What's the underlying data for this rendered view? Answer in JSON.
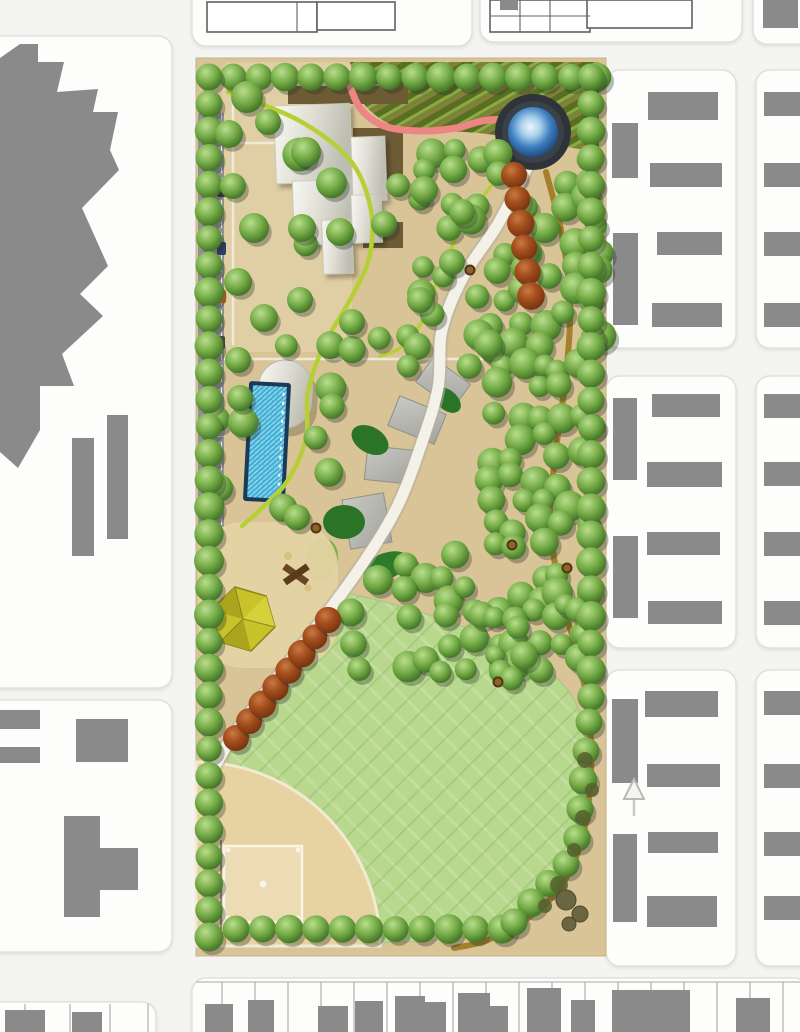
{
  "plan": {
    "kind": "park-master-plan",
    "orientation": "north-up"
  },
  "palette": {
    "canvas": "#f4f4f2",
    "block": "#fdfdfc",
    "block_border": "#dcdcd8",
    "building_gray": "#8a8a8a",
    "park_tan": "#d8c497",
    "road_gray": "#8f9193",
    "lawn_green": "#b8d88d",
    "infield_tan": "#e7d2a2",
    "pond_ring": "#2f343a",
    "pond_water": "#3d7fc1",
    "pool_water": "#3fb0d6",
    "pool_deck": "#1b3a57",
    "path_pink": "#ee8585",
    "path_chartreuse": "#b6cf36",
    "path_dirt": "#a5802c",
    "path_walk": "#f4f2e8",
    "tree_green": "#74ab47",
    "tree_red": "#9a4518",
    "plaza_brown": "#6d5b35",
    "terrace_gray": "#b9b9b4",
    "slope_green": "#2b7326",
    "pavilion_yellow": "#c9c32b"
  },
  "scene": {
    "blocks": [
      [
        -44,
        36,
        216,
        652
      ],
      [
        -44,
        700,
        216,
        252
      ],
      [
        -44,
        1002,
        200,
        62
      ],
      [
        192,
        -36,
        280,
        82
      ],
      [
        480,
        -36,
        262,
        78
      ],
      [
        753,
        -36,
        70,
        80
      ],
      [
        606,
        70,
        130,
        278
      ],
      [
        606,
        376,
        130,
        272
      ],
      [
        606,
        670,
        130,
        296
      ],
      [
        756,
        70,
        80,
        278
      ],
      [
        756,
        376,
        80,
        272
      ],
      [
        756,
        670,
        80,
        296
      ],
      [
        192,
        978,
        616,
        86
      ]
    ],
    "zigzag": "0,58 20,44 38,44 38,62 64,62 57,92 98,89 93,112 118,112 110,150 119,170 82,208 108,266 80,294 103,316 62,354 74,386 40,386 40,430 18,468 0,452",
    "gray_buildings": [
      [
        72,
        438,
        22,
        118
      ],
      [
        107,
        415,
        21,
        124
      ],
      [
        -20,
        710,
        60,
        19
      ],
      [
        -20,
        747,
        60,
        16
      ],
      [
        76,
        719,
        52,
        43
      ],
      [
        64,
        816,
        36,
        101
      ],
      [
        100,
        848,
        38,
        42
      ],
      [
        648,
        92,
        70,
        28
      ],
      [
        612,
        123,
        26,
        55
      ],
      [
        650,
        163,
        72,
        24
      ],
      [
        613,
        233,
        25,
        92
      ],
      [
        657,
        232,
        65,
        23
      ],
      [
        652,
        303,
        70,
        24
      ],
      [
        613,
        398,
        24,
        82
      ],
      [
        652,
        394,
        68,
        23
      ],
      [
        647,
        462,
        75,
        25
      ],
      [
        613,
        536,
        25,
        82
      ],
      [
        647,
        532,
        73,
        23
      ],
      [
        648,
        601,
        74,
        23
      ],
      [
        612,
        699,
        26,
        84
      ],
      [
        645,
        691,
        73,
        26
      ],
      [
        647,
        764,
        73,
        23
      ],
      [
        613,
        834,
        24,
        88
      ],
      [
        648,
        832,
        70,
        21
      ],
      [
        647,
        896,
        70,
        31
      ],
      [
        764,
        92,
        36,
        24
      ],
      [
        764,
        163,
        36,
        24
      ],
      [
        764,
        232,
        36,
        24
      ],
      [
        764,
        303,
        36,
        24
      ],
      [
        764,
        394,
        36,
        24
      ],
      [
        764,
        462,
        36,
        24
      ],
      [
        764,
        532,
        36,
        24
      ],
      [
        764,
        601,
        36,
        24
      ],
      [
        764,
        691,
        36,
        24
      ],
      [
        764,
        764,
        36,
        24
      ],
      [
        764,
        832,
        36,
        24
      ],
      [
        764,
        896,
        36,
        24
      ],
      [
        763,
        0,
        35,
        28
      ]
    ],
    "outline_buildings": [
      [
        207,
        2,
        110,
        30
      ],
      [
        317,
        2,
        78,
        28
      ],
      [
        490,
        0,
        100,
        32
      ],
      [
        587,
        0,
        105,
        28
      ]
    ],
    "outline_lines": [
      [
        297,
        2,
        297,
        32
      ],
      [
        520,
        0,
        520,
        32
      ],
      [
        550,
        0,
        550,
        32
      ],
      [
        490,
        16,
        590,
        16
      ],
      [
        500,
        0,
        518,
        10
      ]
    ],
    "bottom_dividers": [
      222,
      255,
      288,
      321,
      354,
      387,
      420,
      453,
      486,
      519,
      552,
      585,
      618,
      651,
      684,
      717,
      750,
      783
    ],
    "west_strip_dividers": [
      25,
      70,
      110,
      148
    ],
    "west_strip_squares": [
      [
        5,
        1010,
        40,
        22
      ],
      [
        72,
        1012,
        30,
        20
      ]
    ],
    "footprints": [
      [
        205,
        1004,
        28,
        28
      ],
      [
        248,
        1000,
        26,
        32
      ],
      [
        318,
        1006,
        30,
        26
      ],
      [
        355,
        1001,
        28,
        31
      ],
      [
        395,
        996,
        30,
        36
      ],
      [
        424,
        1002,
        22,
        30
      ],
      [
        458,
        993,
        32,
        39
      ],
      [
        490,
        1006,
        18,
        26
      ],
      [
        527,
        988,
        34,
        44
      ],
      [
        571,
        1000,
        24,
        32
      ],
      [
        612,
        990,
        78,
        42
      ],
      [
        736,
        998,
        34,
        34
      ]
    ],
    "paths": [
      {
        "name": "pink-garden-walk",
        "color": "#ee8585",
        "width": 7,
        "points": [
          [
            348,
            80
          ],
          [
            360,
            108
          ],
          [
            384,
            126
          ],
          [
            420,
            131
          ],
          [
            456,
            128
          ],
          [
            482,
            121
          ],
          [
            505,
            120
          ],
          [
            516,
            126
          ]
        ]
      },
      {
        "name": "chartreuse-loop-trail",
        "color": "#b6cf36",
        "width": 4.5,
        "points": [
          [
            228,
            92
          ],
          [
            298,
            120
          ],
          [
            350,
            160
          ],
          [
            371,
            210
          ],
          [
            369,
            258
          ],
          [
            350,
            300
          ],
          [
            324,
            345
          ],
          [
            308,
            392
          ],
          [
            306,
            438
          ],
          [
            288,
            480
          ],
          [
            262,
            508
          ],
          [
            242,
            526
          ]
        ]
      },
      {
        "name": "chartreuse-spur-trail",
        "color": "#b6cf36",
        "width": 3.5,
        "points": [
          [
            512,
            160
          ],
          [
            482,
            198
          ],
          [
            455,
            240
          ],
          [
            436,
            285
          ],
          [
            420,
            325
          ],
          [
            400,
            348
          ],
          [
            380,
            356
          ]
        ]
      },
      {
        "name": "dirt-trail",
        "color": "#a5802c",
        "width": 6,
        "points": [
          [
            546,
            172
          ],
          [
            562,
            235
          ],
          [
            570,
            305
          ],
          [
            566,
            375
          ],
          [
            556,
            450
          ],
          [
            550,
            520
          ],
          [
            560,
            590
          ],
          [
            576,
            650
          ],
          [
            588,
            706
          ],
          [
            591,
            770
          ],
          [
            583,
            835
          ],
          [
            562,
            885
          ],
          [
            528,
            918
          ],
          [
            488,
            940
          ],
          [
            454,
            948
          ]
        ]
      },
      {
        "name": "main-walk",
        "color": "#f4f2e8",
        "casing": "#b4b1a3",
        "width": 11,
        "points": [
          [
            528,
            166
          ],
          [
            498,
            224
          ],
          [
            463,
            277
          ],
          [
            442,
            330
          ],
          [
            438,
            388
          ],
          [
            420,
            448
          ],
          [
            398,
            505
          ],
          [
            368,
            556
          ],
          [
            331,
            608
          ],
          [
            291,
            660
          ],
          [
            255,
            706
          ],
          [
            229,
            742
          ],
          [
            215,
            766
          ]
        ]
      }
    ],
    "tree_rows_green": [
      [
        233,
        77,
        597,
        77,
        26
      ],
      [
        209,
        77,
        209,
        937,
        27
      ],
      [
        236,
        929,
        502,
        929,
        27
      ],
      [
        591,
        77,
        591,
        697,
        27
      ],
      [
        589,
        722,
        577,
        838,
        27
      ],
      [
        566,
        864,
        514,
        922,
        27
      ]
    ],
    "tree_rows_red": [
      [
        514,
        175,
        531,
        296,
        23
      ],
      [
        236,
        738,
        328,
        620,
        23
      ]
    ],
    "tree_clusters": [
      {
        "x": 425,
        "y": 152,
        "w": 175,
        "h": 225,
        "step": 24,
        "density": 0.72,
        "r": 13,
        "seed": 7
      },
      {
        "x": 287,
        "y": 342,
        "w": 312,
        "h": 325,
        "step": 23,
        "density": 0.78,
        "r": 13,
        "seed": 13
      },
      {
        "x": 222,
        "y": 424,
        "w": 74,
        "h": 112,
        "step": 24,
        "density": 0.6,
        "r": 13,
        "seed": 21
      },
      {
        "x": 475,
        "y": 612,
        "w": 120,
        "h": 80,
        "step": 22,
        "density": 0.8,
        "r": 12,
        "seed": 29
      },
      {
        "x": 300,
        "y": 150,
        "w": 120,
        "h": 120,
        "step": 30,
        "density": 0.4,
        "r": 14,
        "seed": 35
      }
    ],
    "tree_singles": [
      [
        247,
        97,
        16
      ],
      [
        268,
        122,
        13
      ],
      [
        229,
        134,
        14
      ],
      [
        306,
        152,
        15
      ],
      [
        233,
        186,
        13
      ],
      [
        254,
        228,
        15
      ],
      [
        302,
        228,
        14
      ],
      [
        340,
        232,
        14
      ],
      [
        384,
        224,
        13
      ],
      [
        238,
        282,
        14
      ],
      [
        264,
        318,
        14
      ],
      [
        300,
        300,
        13
      ],
      [
        352,
        322,
        13
      ],
      [
        420,
        300,
        13
      ],
      [
        452,
        262,
        13
      ],
      [
        424,
        190,
        14
      ],
      [
        462,
        212,
        13
      ],
      [
        238,
        360,
        13
      ],
      [
        240,
        398,
        13
      ]
    ],
    "exclusions": [
      [
        244,
        346,
        70,
        156
      ],
      [
        332,
        370,
        146,
        184
      ],
      [
        196,
        518,
        142,
        154
      ],
      [
        500,
        98,
        76,
        78
      ]
    ],
    "cars": [
      [
        217,
        184,
        "#3a3a3a"
      ],
      [
        217,
        242,
        "#2c3f66"
      ],
      [
        217,
        290,
        "#cd701e"
      ],
      [
        216,
        336,
        "#454545"
      ],
      [
        217,
        424,
        "#c9c9c6"
      ]
    ],
    "picnic_tables": [
      [
        470,
        270
      ],
      [
        316,
        528
      ],
      [
        567,
        568
      ],
      [
        498,
        682
      ],
      [
        512,
        545
      ]
    ],
    "shrubs": [
      [
        585,
        760,
        8
      ],
      [
        592,
        790,
        7
      ],
      [
        583,
        818,
        8
      ],
      [
        574,
        850,
        7
      ],
      [
        559,
        885,
        9
      ],
      [
        545,
        906,
        7
      ]
    ],
    "rocks": [
      [
        566,
        900,
        10
      ],
      [
        580,
        914,
        8
      ],
      [
        569,
        924,
        7
      ]
    ]
  }
}
